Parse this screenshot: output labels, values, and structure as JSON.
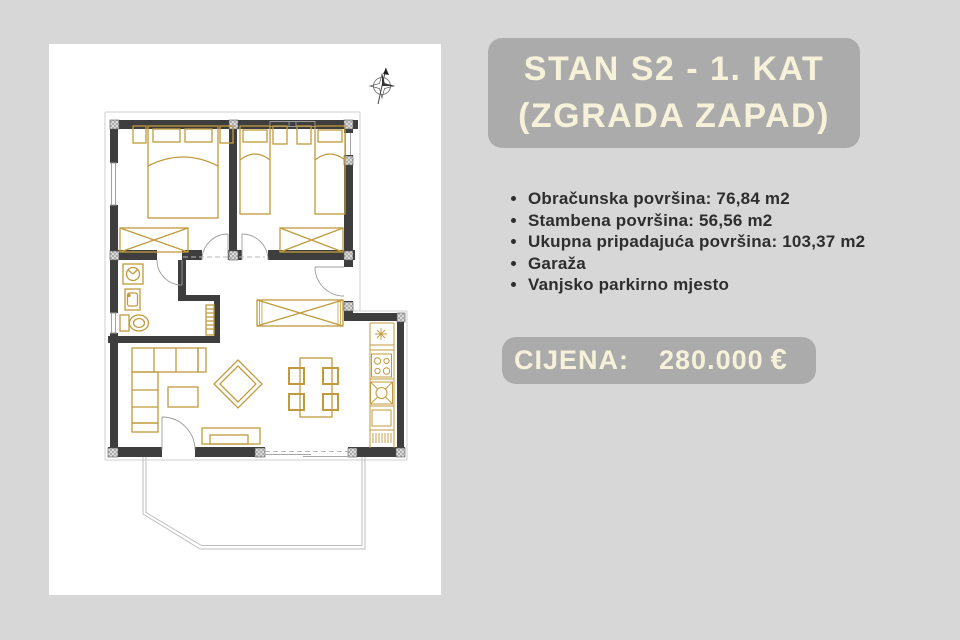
{
  "title": {
    "line1": "STAN S2 - 1. KAT",
    "line2": "(ZGRADA ZAPAD)"
  },
  "details": {
    "items": [
      "Obračunska površina: 76,84 m2",
      "Stambena površina: 56,56 m2",
      "Ukupna pripadajuća površina: 103,37 m2",
      "Garaža",
      "Vanjsko parkirno mjesto"
    ]
  },
  "price": {
    "label": "CIJENA:",
    "amount": "280.000",
    "currency": "€"
  },
  "colors": {
    "background": "#d7d7d7",
    "panel": "#ffffff",
    "box": "#ababab",
    "boxText": "#f6f2da",
    "bodyText": "#2e2e2e",
    "wall": "#3e3e3e",
    "furniture": "#c09a3c",
    "lightLine": "#bdbdbd"
  }
}
